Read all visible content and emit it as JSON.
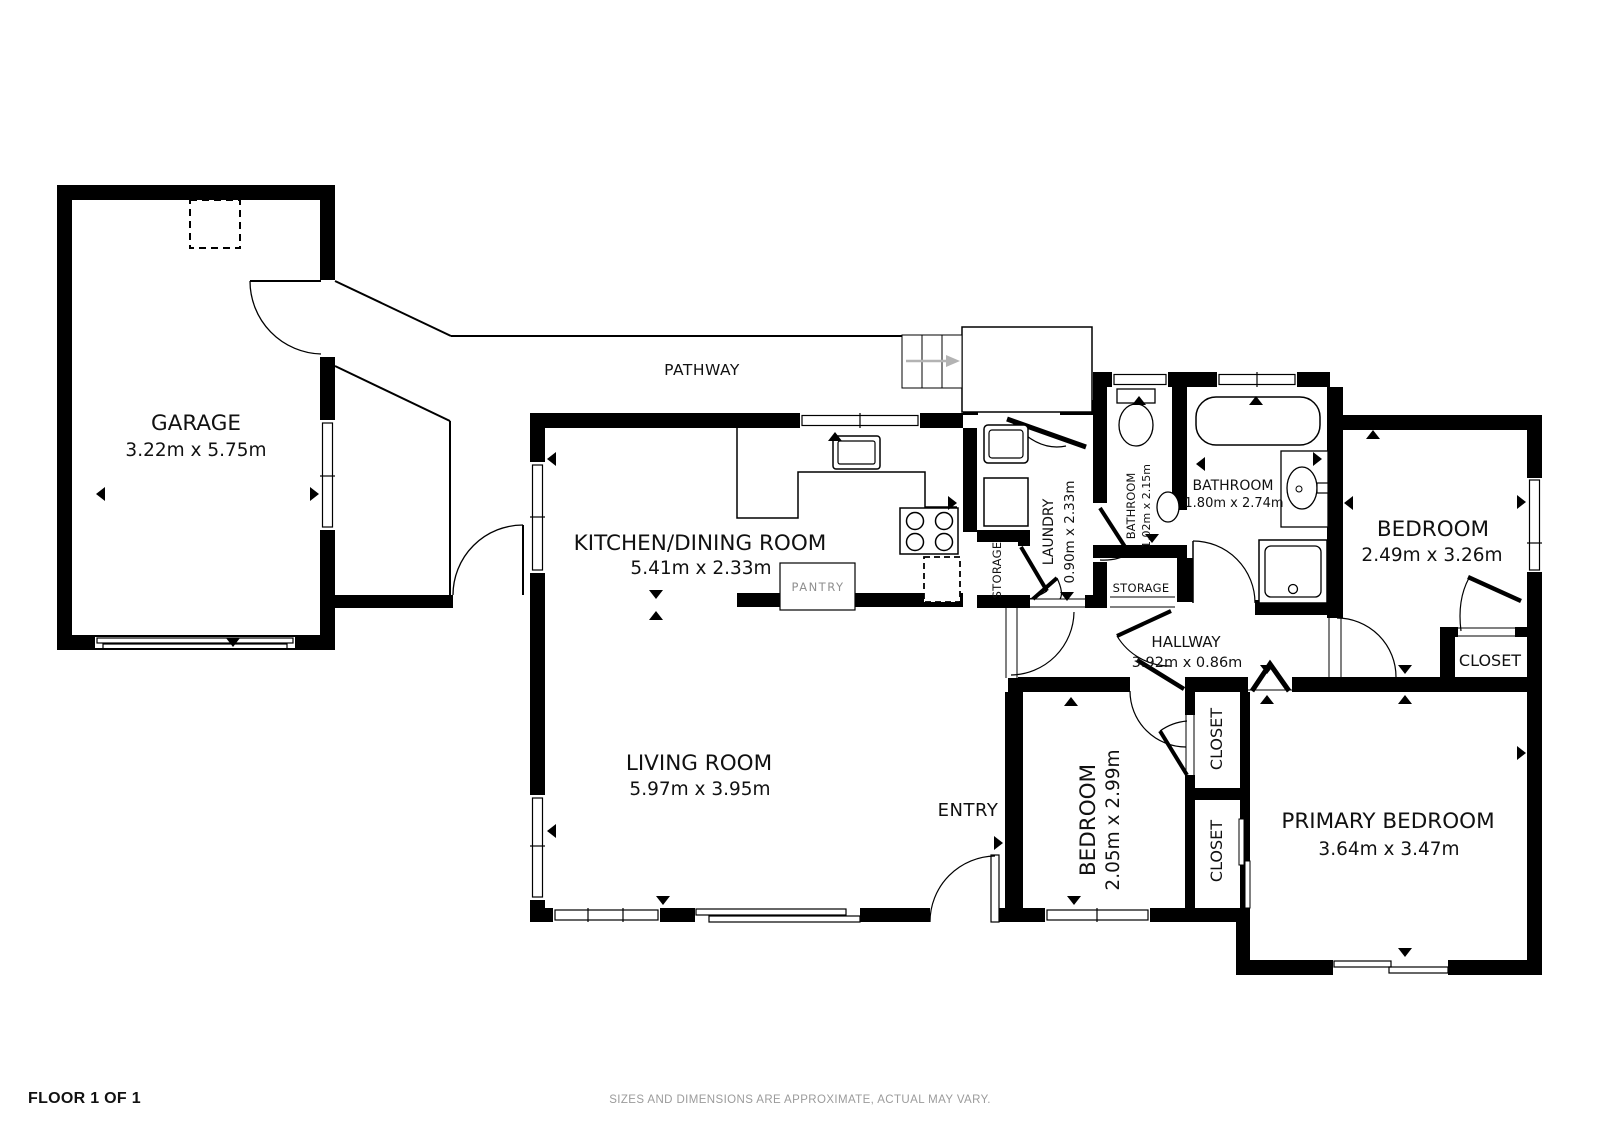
{
  "footer": {
    "floor_label": "FLOOR 1 OF 1",
    "disclaimer": "SIZES AND DIMENSIONS ARE APPROXIMATE, ACTUAL MAY VARY."
  },
  "labels": {
    "pathway": "PATHWAY",
    "entry": "ENTRY",
    "pantry": "PANTRY",
    "storage_kitchen": "STORAGE",
    "storage_hall": "STORAGE",
    "closet_right": "CLOSET",
    "closet_upper": "CLOSET",
    "closet_lower": "CLOSET"
  },
  "rooms": {
    "garage": {
      "name": "GARAGE",
      "dims": "3.22m x 5.75m"
    },
    "kitchen_dining": {
      "name": "KITCHEN/DINING ROOM",
      "dims": "5.41m x 2.33m"
    },
    "living_room": {
      "name": "LIVING ROOM",
      "dims": "5.97m x 3.95m"
    },
    "laundry": {
      "name": "LAUNDRY",
      "dims": "0.90m x 2.33m"
    },
    "bathroom_small": {
      "name": "BATHROOM",
      "dims": "1.02m x 2.15m"
    },
    "bathroom_main": {
      "name": "BATHROOM",
      "dims": "1.80m x 2.74m"
    },
    "bedroom_right": {
      "name": "BEDROOM",
      "dims": "2.49m x 3.26m"
    },
    "bedroom_middle": {
      "name": "BEDROOM",
      "dims": "2.05m x 2.99m"
    },
    "primary_bedroom": {
      "name": "PRIMARY BEDROOM",
      "dims": "3.64m x 3.47m"
    },
    "hallway": {
      "name": "HALLWAY",
      "dims": "3.92m x 0.86m"
    }
  },
  "colors": {
    "wall": "#000000",
    "muted_text": "#9b9b9b",
    "arrow_gray": "#b3b3b3"
  }
}
